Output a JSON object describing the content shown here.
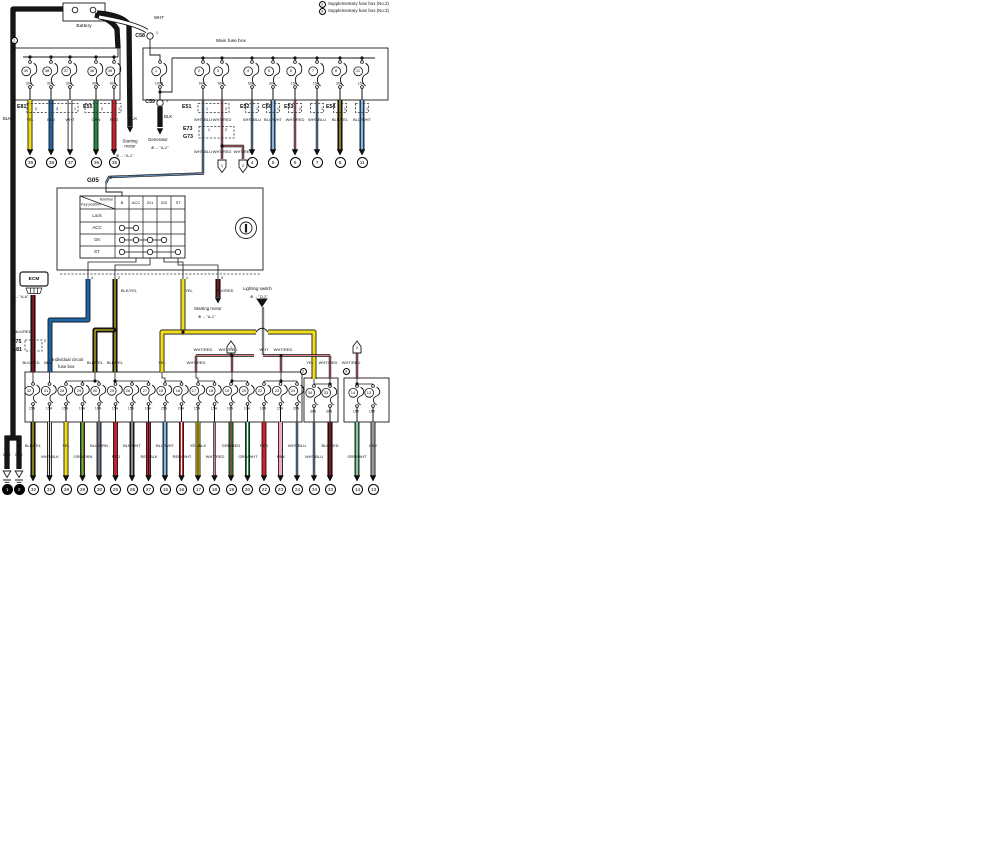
{
  "colors": {
    "yellow": "#f0de1e",
    "blue": "#1e63a5",
    "green": "#1d8a3f",
    "red": "#cc1f2e",
    "black": "#161616",
    "white": "#ffffff",
    "orange": "#ef7d1a",
    "pink": "#f2a9bd",
    "gray": "#9a9a9a",
    "dark_red": "#2b1010",
    "pale_blue": "#e3ebf4",
    "pale_red": "#f2e2e2",
    "pale_white": "#ededed"
  },
  "legend": {
    "items": [
      {
        "mark": "2",
        "text": "Supplementary fuse box (No.2)"
      },
      {
        "mark": "3",
        "text": "Supplementary fuse box (No.3)"
      }
    ]
  },
  "battery": {
    "label": "Battery"
  },
  "main_fuse_box": {
    "title": "Main fuse box",
    "wht_label": "WHT",
    "blk_label": "BLK",
    "c58": {
      "name": "C58",
      "pin": "1"
    },
    "c59": {
      "name": "C59",
      "pin": "1"
    },
    "fuses": [
      {
        "num": "1",
        "amp": "100A"
      },
      {
        "num": "2",
        "amp": "60A"
      },
      {
        "num": "3",
        "amp": "80A"
      },
      {
        "num": "4",
        "amp": "60A"
      },
      {
        "num": "5",
        "amp": "30A"
      },
      {
        "num": "6",
        "amp": "15A"
      },
      {
        "num": "7",
        "amp": "15A"
      },
      {
        "num": "8",
        "amp": "30A"
      },
      {
        "num": "11",
        "amp": "15A"
      }
    ],
    "connectors": [
      "E51",
      "E52",
      "C60",
      "E53",
      "E54"
    ],
    "pins": [
      "1",
      "2",
      "1",
      "1",
      "2",
      "1",
      "1",
      "1"
    ],
    "wire_labels": [
      "WHT/BLU",
      "WHT/RED",
      "WHT/BLU",
      "BLU/WHT",
      "WHT/RED",
      "WHT/BLU",
      "BLK/YEL",
      "BLU/WHT"
    ],
    "terminals": [
      "4",
      "5",
      "6",
      "7",
      "8",
      "11"
    ]
  },
  "left_fuse_box": {
    "mark": "1",
    "battery_wire_labels": [
      "BLK",
      "BLK"
    ],
    "fuses": [
      {
        "num": "39",
        "amp": "30A"
      },
      {
        "num": "38",
        "amp": "30A"
      },
      {
        "num": "37",
        "amp": "30A"
      },
      {
        "num": "36",
        "amp": "30A"
      },
      {
        "num": "35",
        "amp": "60A"
      }
    ],
    "connectors": [
      "E81",
      "E55"
    ],
    "pins": [
      "2",
      "3",
      "1",
      "2",
      "1"
    ],
    "wire_labels": [
      "YEL",
      "BLU",
      "WHT",
      "GRN",
      "RED"
    ],
    "terminals": [
      "39",
      "38",
      "37",
      "36",
      "35"
    ]
  },
  "e73_g73": {
    "names": [
      "E73",
      "G73"
    ],
    "pins": [
      "1",
      "2"
    ],
    "wire_labels": [
      "WHT/BLU",
      "WHT/RED",
      "WHT/RED"
    ],
    "arrow_refs": [
      "1",
      "2"
    ]
  },
  "g05": {
    "name": "G05",
    "pin": "6"
  },
  "refs": {
    "generator": {
      "name": "Generator",
      "ref": "⊕→ \"A-2\""
    },
    "starting_motor_top": {
      "name": "Starting motor",
      "ref": "⊕→ \"A-1\""
    },
    "starting_motor_mid": {
      "name": "Starting motor",
      "ref": "⊕→ \"A-1\""
    },
    "lighting_switch": {
      "name": "Lighting switch",
      "ref": "⊕→ \"D-2\""
    },
    "ecm": {
      "ref": "⊕→ \"A-6\""
    }
  },
  "ignition_switch": {
    "corner": {
      "top": "Terminal",
      "bottom": "Key position"
    },
    "columns": [
      "B",
      "ACC",
      "IG1",
      "IG2",
      "ST"
    ],
    "rows": [
      "Lock",
      "ACC",
      "On",
      "ST"
    ],
    "contacts": {
      "ACC": [
        "B",
        "ACC"
      ],
      "On": [
        "B",
        "ACC",
        "IG1",
        "IG2"
      ],
      "ST": [
        "B",
        "IG1",
        "ST"
      ]
    },
    "pins": [
      "4",
      "2",
      "1",
      "3"
    ],
    "pin_wire_labels": [
      "BLK/YEL",
      "YEL",
      "BLK/RED"
    ]
  },
  "ecm": {
    "label": "ECM",
    "wire_label": "BLK/RED",
    "connector": {
      "names": [
        "E75",
        "G81"
      ],
      "pin": "2"
    }
  },
  "individual_fuse_box": {
    "label": [
      "Individual circuit",
      "fuse box"
    ],
    "top_wire_labels": [
      "BLK/RED",
      "BLU",
      "BLK/YEL",
      "BLK/YEL",
      "YEL",
      "WHT/RED"
    ],
    "bus_wire_labels": [
      "WHT/RED",
      "WHT/RED",
      "WHT",
      "WHT/RED"
    ],
    "arrow_refs": [
      "1",
      "2"
    ],
    "supp_wire_labels": [
      "YEL",
      "WHT/RED",
      "WHT/RED"
    ],
    "fuses": [
      {
        "num": "32",
        "amp": "15A"
      },
      {
        "num": "31",
        "amp": "15A"
      },
      {
        "num": "28",
        "amp": "15A"
      },
      {
        "num": "29",
        "amp": "10A"
      },
      {
        "num": "30",
        "amp": "10A"
      },
      {
        "num": "25",
        "amp": "15A"
      },
      {
        "num": "26",
        "amp": "15A"
      },
      {
        "num": "27",
        "amp": "10A"
      },
      {
        "num": "15",
        "amp": "25A"
      },
      {
        "num": "16",
        "amp": "20A"
      },
      {
        "num": "17",
        "amp": "15A"
      },
      {
        "num": "18",
        "amp": "15A"
      },
      {
        "num": "19",
        "amp": "10A"
      },
      {
        "num": "20",
        "amp": "10A"
      },
      {
        "num": "22",
        "amp": "10A"
      },
      {
        "num": "23",
        "amp": "15A"
      },
      {
        "num": "24",
        "amp": "20A"
      }
    ],
    "supp2": {
      "mark": "2",
      "fuses": [
        {
          "num": "34",
          "amp": "30A"
        },
        {
          "num": "33",
          "amp": "30A"
        }
      ]
    },
    "supp3": {
      "mark": "3",
      "fuses": [
        {
          "num": "14",
          "amp": "15A"
        },
        {
          "num": "13",
          "amp": "15A"
        }
      ]
    }
  },
  "bottom_terminals": [
    {
      "label": "BLK",
      "num": "1",
      "type": "ground"
    },
    {
      "label": "BLK",
      "num": "2",
      "type": "ground"
    },
    {
      "label": "BLK/YEL",
      "num": "32"
    },
    {
      "label": "WHT/BLK",
      "num": "31"
    },
    {
      "label": "YEL",
      "num": "28"
    },
    {
      "label": "GRN/ORN",
      "num": "29"
    },
    {
      "label": "BLU/ORN",
      "num": "30"
    },
    {
      "label": "RED",
      "num": "25"
    },
    {
      "label": "BLK/WHT",
      "num": "26"
    },
    {
      "label": "RED/BLK",
      "num": "27"
    },
    {
      "label": "BLU/WHT",
      "num": "15"
    },
    {
      "label": "RED/WHT",
      "num": "16"
    },
    {
      "label": "YEL/BLK",
      "num": "17"
    },
    {
      "label": "WHT/RED",
      "num": "18"
    },
    {
      "label": "GRN/RED",
      "num": "19"
    },
    {
      "label": "GRN/WHT",
      "num": "20"
    },
    {
      "label": "RED",
      "num": "22"
    },
    {
      "label": "PNK",
      "num": "23"
    },
    {
      "label": "WHT/BLU",
      "num": "24"
    },
    {
      "label": "WHT/BLU",
      "num": "34"
    },
    {
      "label": "BLK/RED",
      "num": "33"
    },
    {
      "label": "GRN/WHT",
      "num": "14"
    },
    {
      "label": "GRY",
      "num": "13"
    }
  ]
}
